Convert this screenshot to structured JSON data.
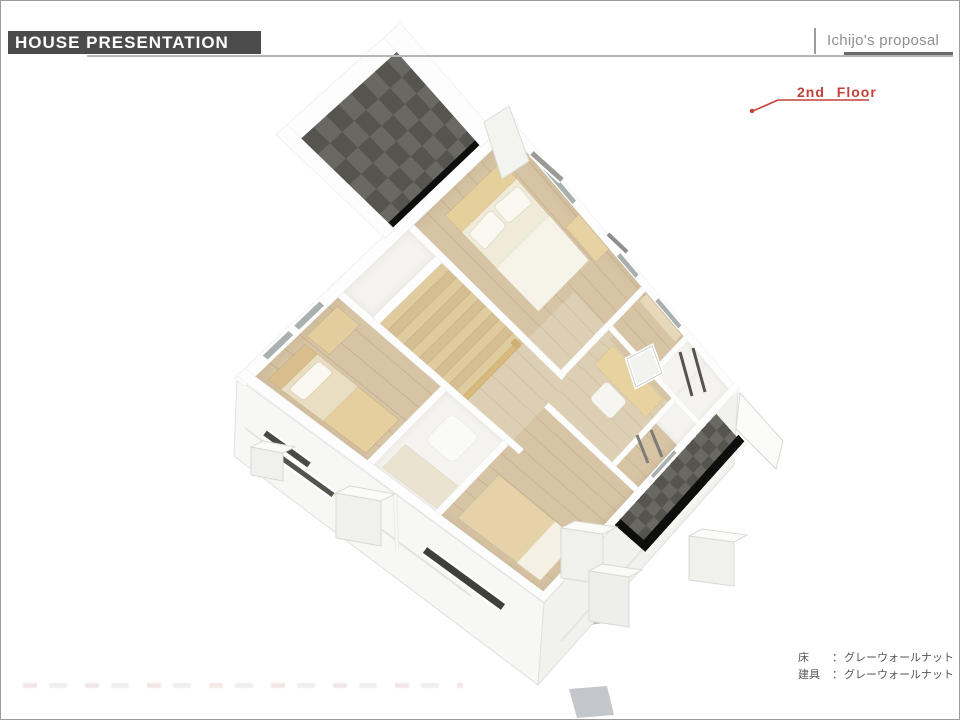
{
  "header": {
    "title": "HOUSE PRESENTATION",
    "proposal_label": "Ichijo's proposal"
  },
  "floor_label": "2nd Floor",
  "legend": {
    "rows": [
      {
        "label": "床",
        "colon": "：",
        "value": "グレーウォールナット"
      },
      {
        "label": "建具",
        "colon": "：",
        "value": "グレーウォールナット"
      }
    ]
  },
  "colors": {
    "accent_red": "#c4403a",
    "header_bar": "#4b4b4b",
    "header_text": "#ffffff",
    "proposal_text": "#8f8f8f",
    "rule_gray": "#b5b5b5",
    "rule_dark": "#6a6a6a",
    "legend_text": "#565656",
    "wood_floor": "#d7c4a4",
    "balcony_dark": "#56544f",
    "balcony_checker": "#6a6862",
    "balcony_edge_black": "#0e0e0c",
    "wall_white": "#fdfdfd",
    "facade_white": "#f7f7f5",
    "furniture_tan": "#e5cf9f",
    "mattress_cream": "#f0ead9",
    "ground_shadow": "#b9bcc0"
  }
}
